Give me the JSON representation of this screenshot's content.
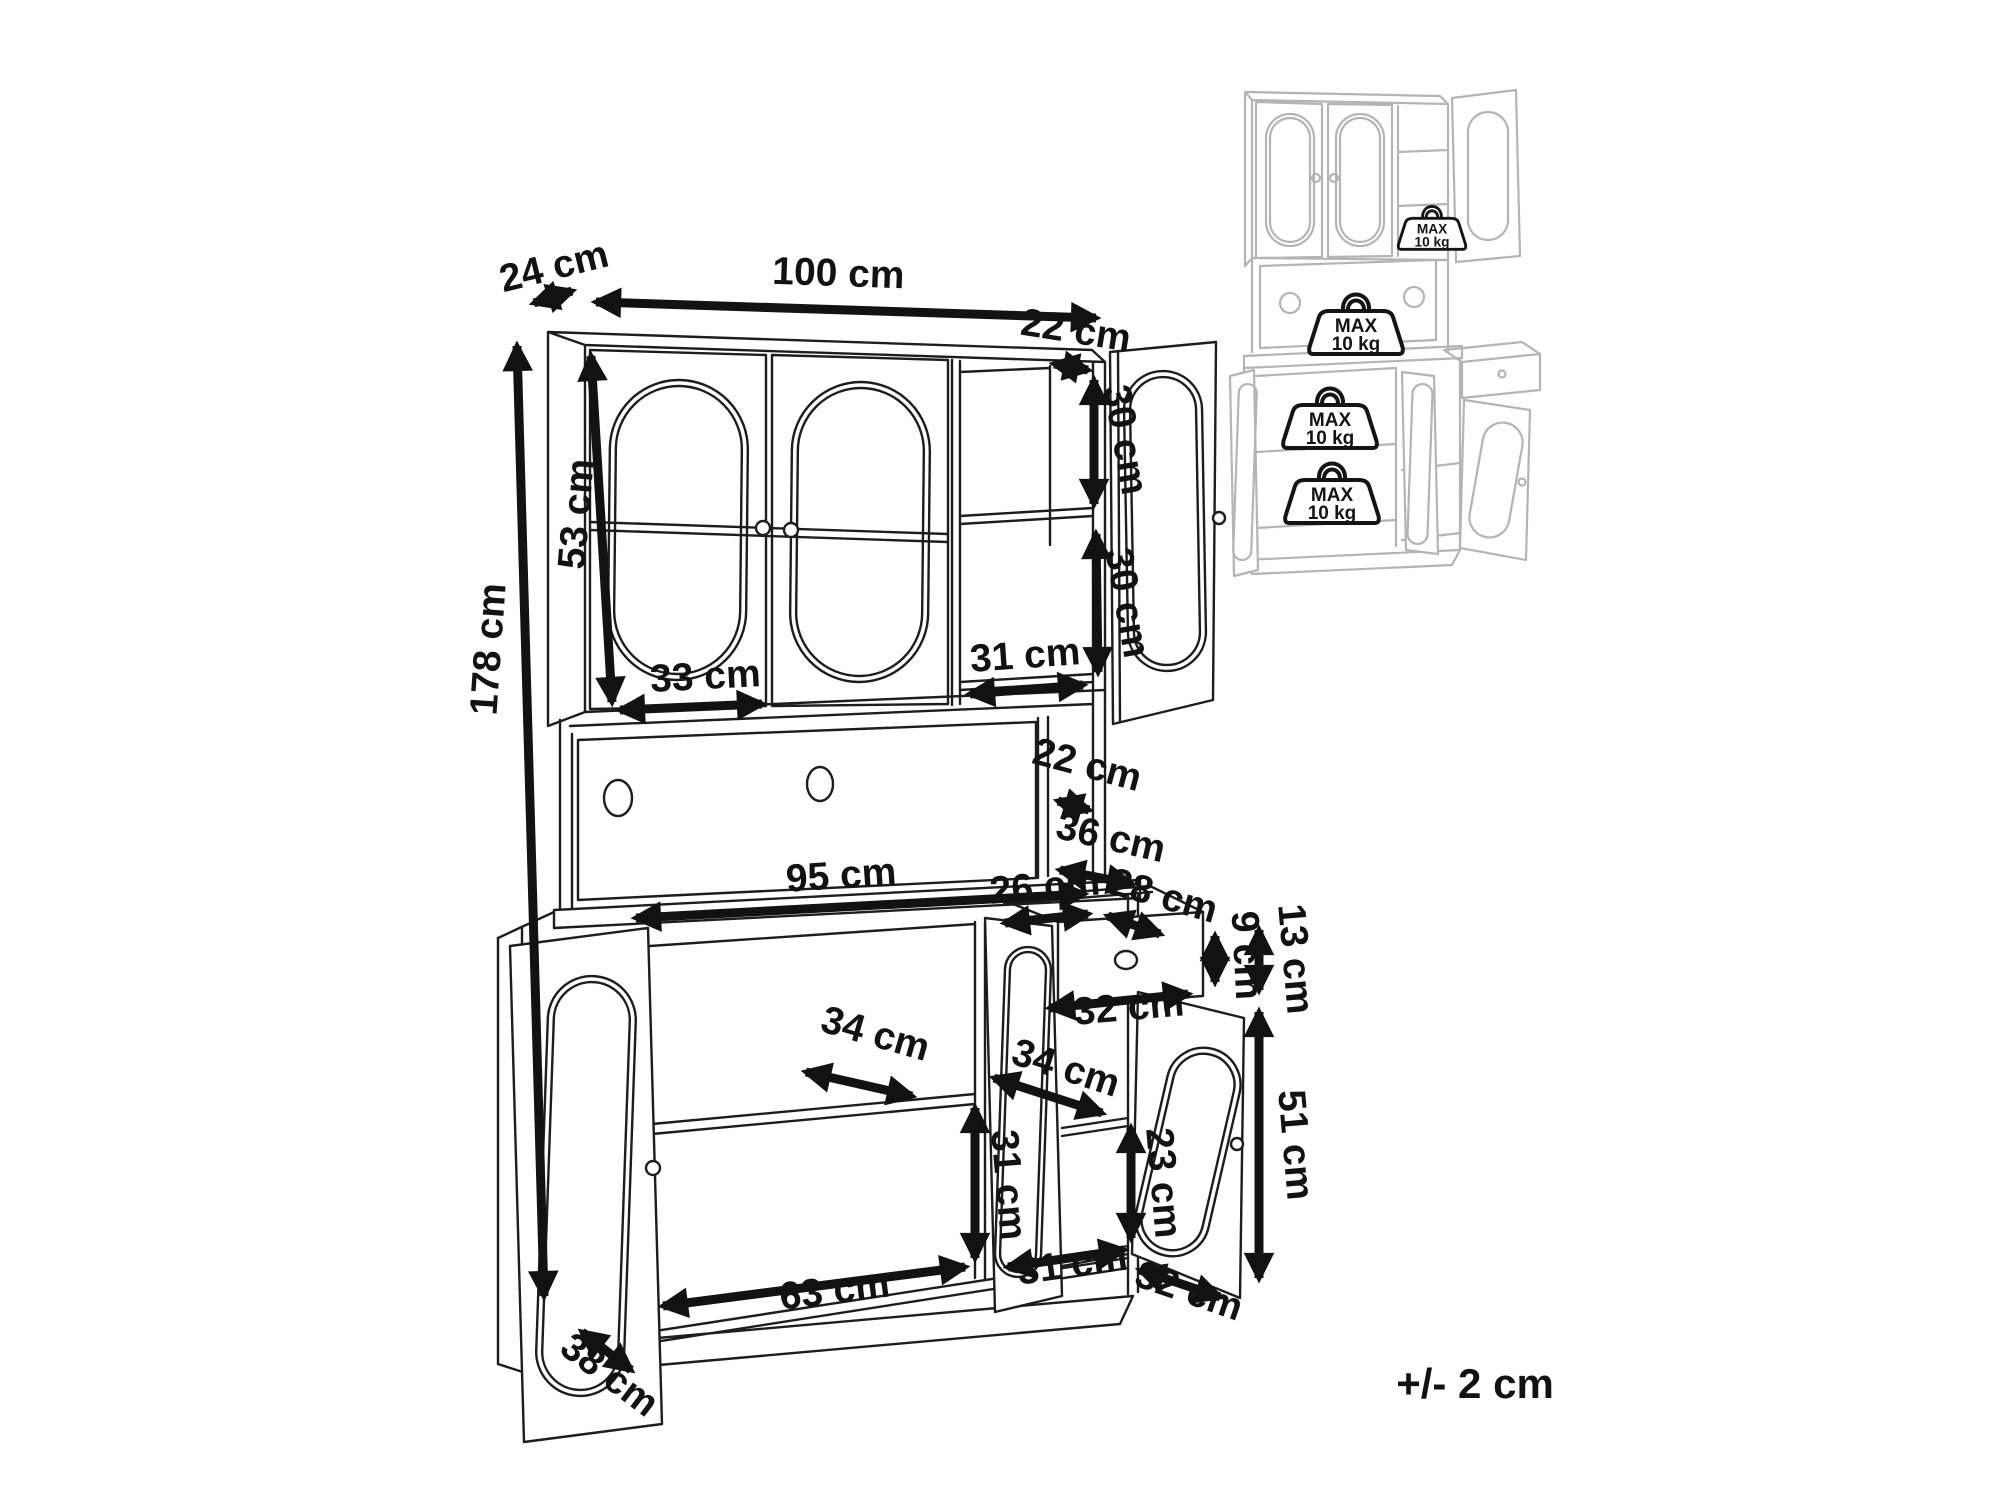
{
  "figure": {
    "kind": "furniture-dimension-diagram",
    "tolerance_note": "+/- 2 cm"
  },
  "dims": {
    "top_depth": "24 cm",
    "total_width": "100 cm",
    "upper_inner_depth": "22 cm",
    "upper_shelf_top": "30 cm",
    "upper_shelf_bottom": "30 cm",
    "upper_height": "53 cm",
    "upper_door_width": "33 cm",
    "upper_open_width": "31 cm",
    "total_height": "178 cm",
    "niche_depth": "22 cm",
    "counter_depth": "36 cm",
    "counter_width": "95 cm",
    "drawer_opening_width": "26 cm",
    "drawer_depth": "28 cm",
    "drawer_inner_height": "9 cm",
    "drawer_front_height": "13 cm",
    "lower_right_width": "32 cm",
    "lower_left_shelf_depth": "34 cm",
    "lower_right_shelf_depth": "34 cm",
    "lower_left_inner_height": "31 cm",
    "lower_right_shelf_height": "23 cm",
    "lower_door_height": "51 cm",
    "lower_left_inner_width": "63 cm",
    "lower_bottom_width": "31 cm",
    "lower_bottom_depth": "32 cm",
    "base_depth": "38 cm"
  },
  "inset": {
    "max_load_line1": "MAX",
    "max_load_line2": "10 kg"
  }
}
